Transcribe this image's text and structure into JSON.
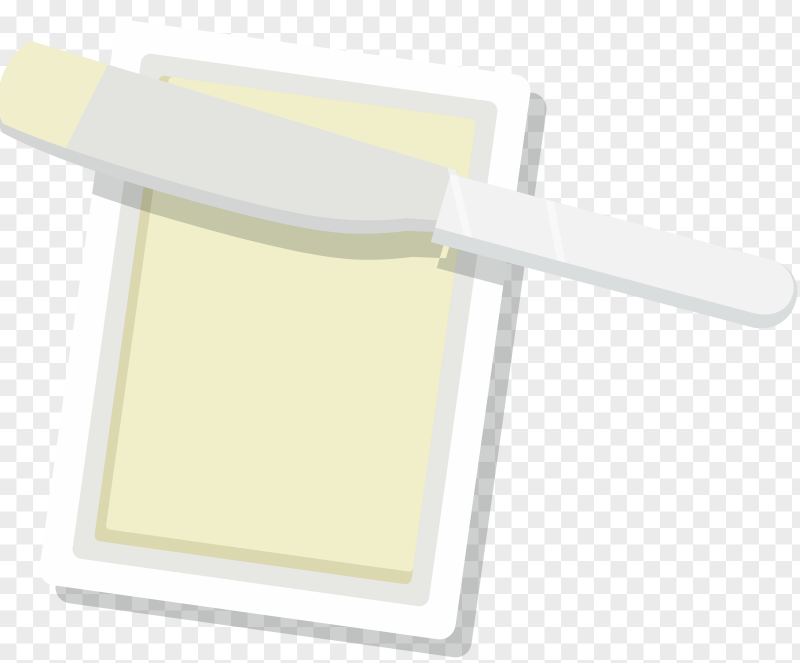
{
  "scene": {
    "description": "Flat-design illustration of a butter knife with butter on its tip resting across a butter dish, shown over a transparency checkerboard",
    "objects": [
      "transparency-checkerboard",
      "butter-dish",
      "butter-block",
      "butter-knife"
    ]
  },
  "canvas": {
    "width": 800,
    "height": 663,
    "checker_square_px": 16.5,
    "checker_light": "#ffffff",
    "checker_dark": "#ebebeb"
  },
  "colors": {
    "plate_white": "#fefefe",
    "plate_inner": "#e7e7e4",
    "butter_cream": "#f1efca",
    "butter_side": "#dbd7ae",
    "blade_top": "#e3e3e0",
    "blade_side": "#d2d5d3",
    "handle_top": "#f2f2f2",
    "handle_side": "#dadddd",
    "smear_cream": "#f1efcb",
    "shadow": "rgba(55,66,58,0.25)",
    "knife_shadow": "rgba(55,66,58,0.24)",
    "glare": "rgba(255,255,255,0.45)"
  }
}
